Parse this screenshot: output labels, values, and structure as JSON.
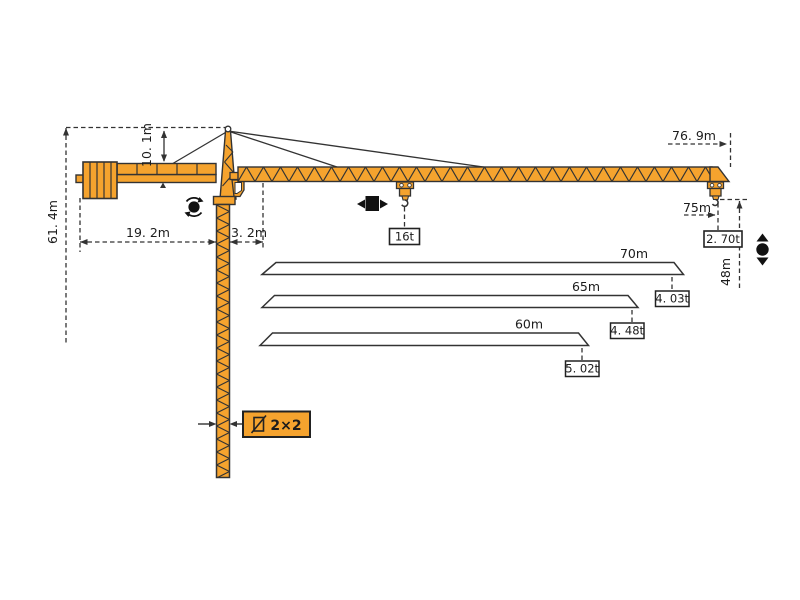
{
  "diagram_title": "Tower crane working range and load capacity diagram",
  "colors": {
    "crane_orange": "#F5A32E",
    "outline": "#333333",
    "background": "#FFFFFF",
    "label_box_fill": "#FFFFFF"
  },
  "labels": {
    "total_height": "61. 4m",
    "tower_head_height": "10. 1m",
    "counter_jib_length": "19. 2m",
    "jib_root_offset": "3. 2m",
    "overall_jib_span": "76. 9m",
    "max_working_radius": "75m",
    "tip_capacity": "2. 70t",
    "hook_height": "48m",
    "max_capacity": "16t",
    "mast_section": "2×2"
  },
  "load_chart": [
    {
      "radius": "70m",
      "capacity": "4. 03t"
    },
    {
      "radius": "65m",
      "capacity": "4. 48t"
    },
    {
      "radius": "60m",
      "capacity": "5. 02t"
    }
  ],
  "icons": {
    "slewing": "rotation-icon",
    "trolley_travel": "trolley-left-right-icon",
    "hoist": "hook-up-down-icon"
  }
}
